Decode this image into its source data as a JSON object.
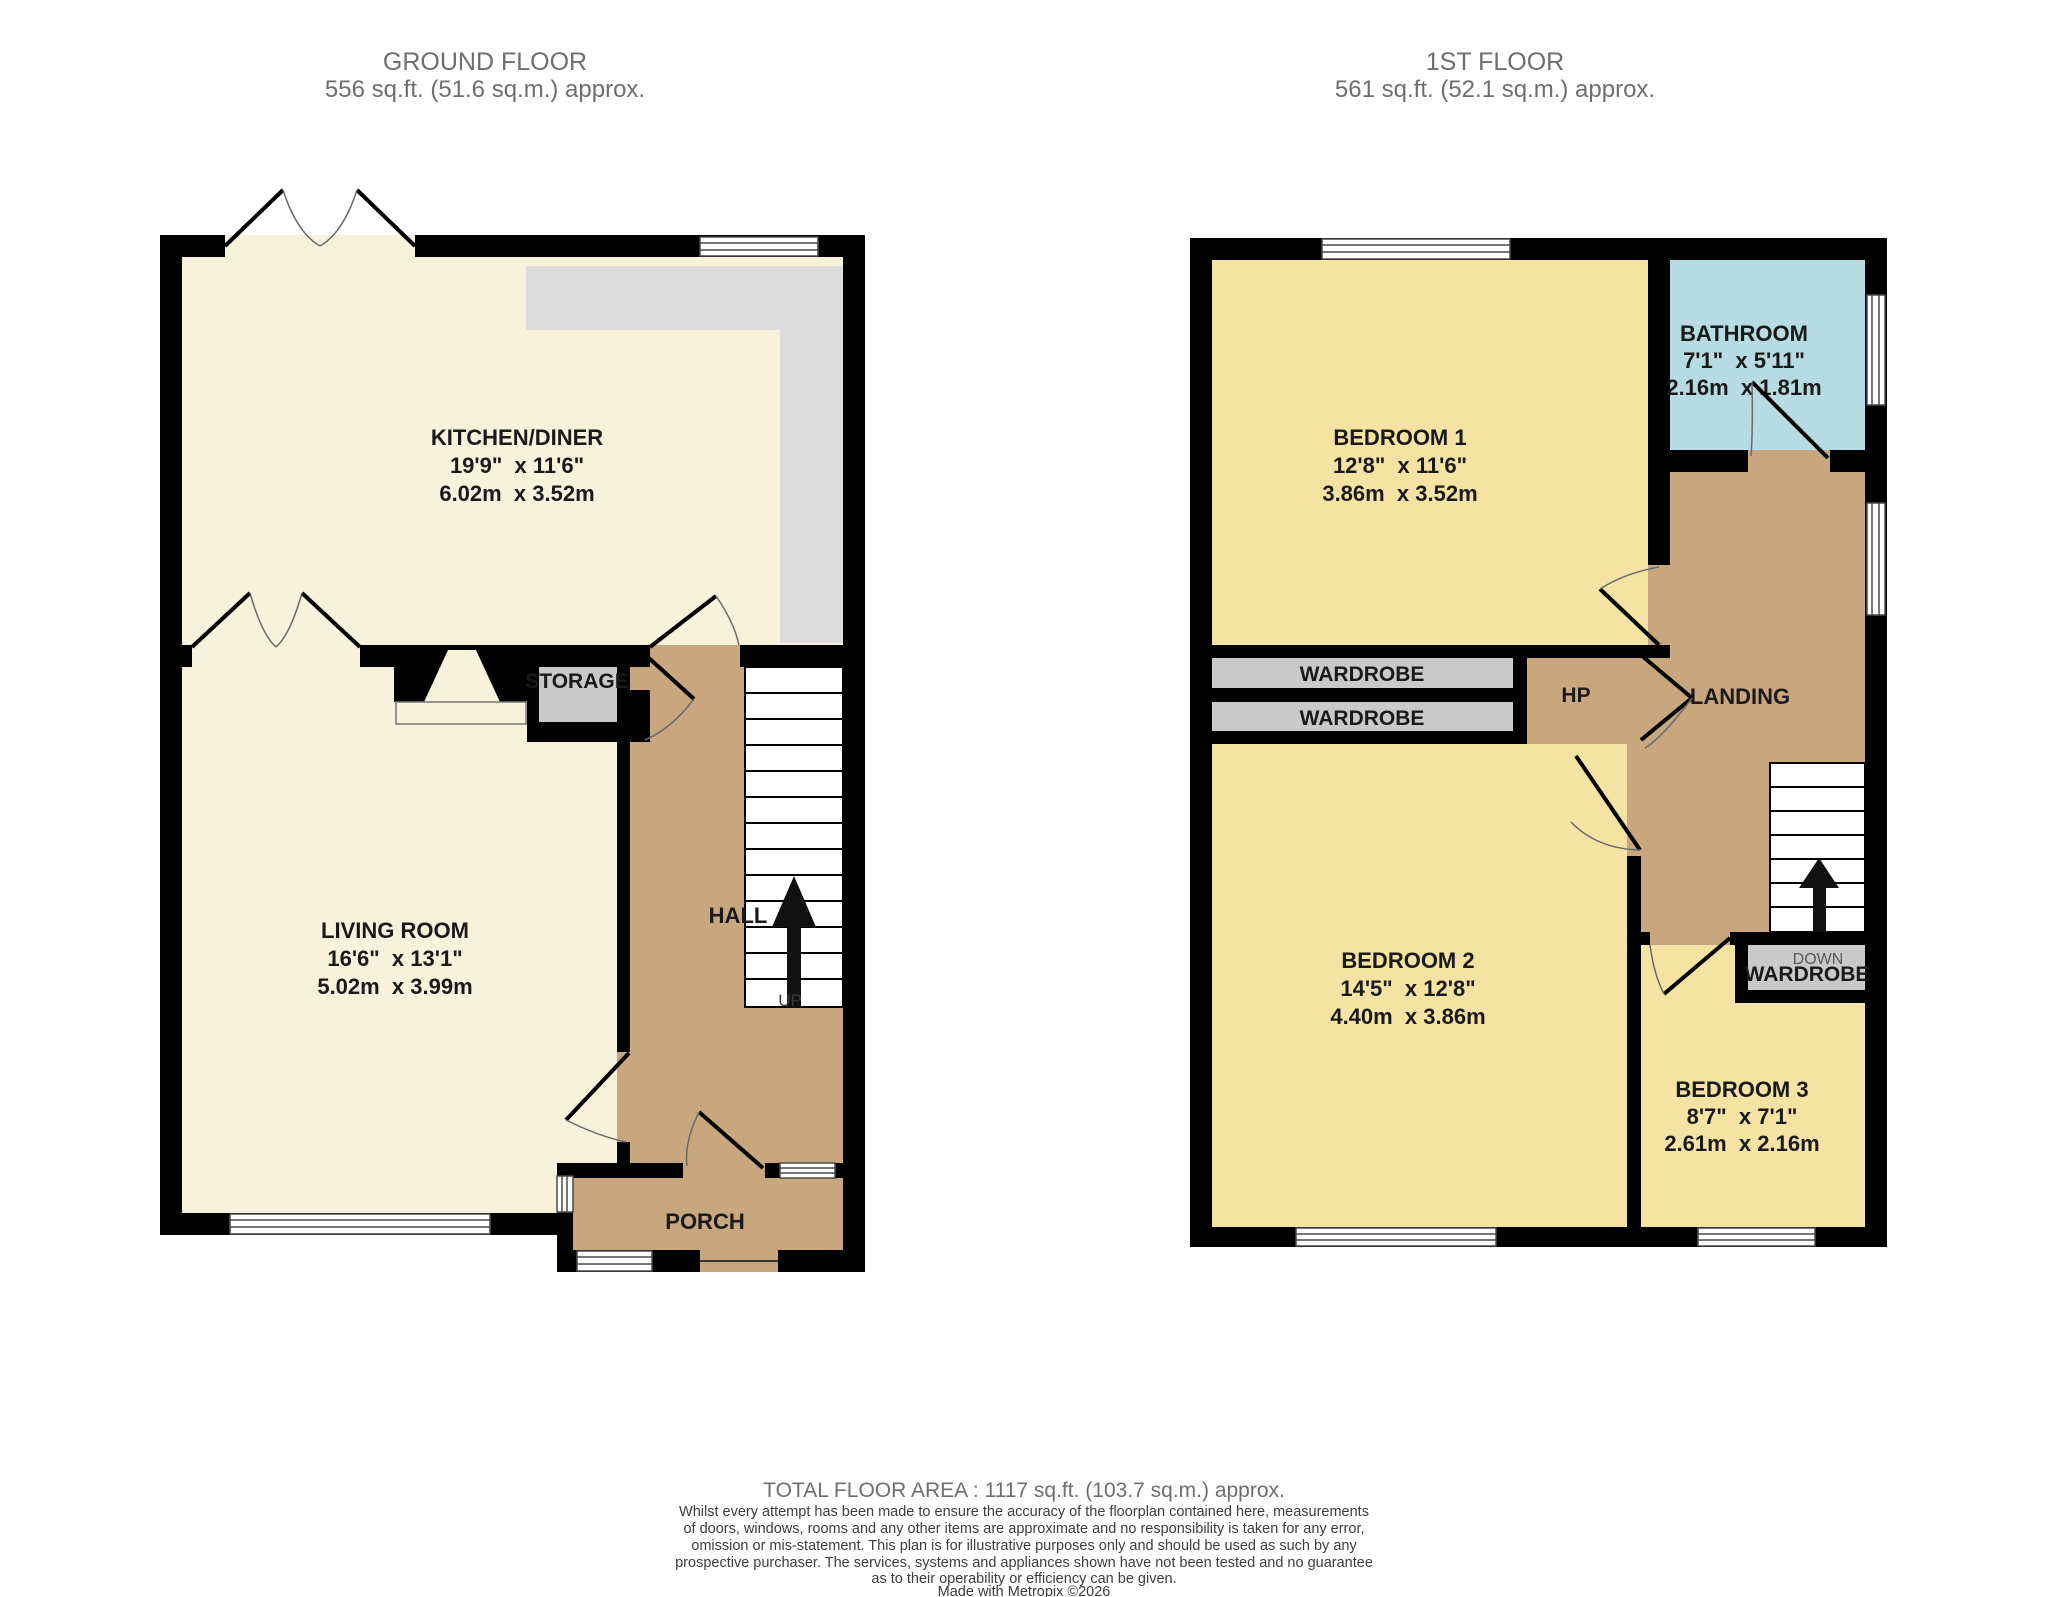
{
  "floors": {
    "ground": {
      "title": "GROUND FLOOR",
      "area": "556 sq.ft. (51.6 sq.m.) approx.",
      "rooms": {
        "kitchen": {
          "name": "KITCHEN/DINER",
          "imperial": "19'9\"  x 11'6\"",
          "metric": "6.02m  x 3.52m"
        },
        "living": {
          "name": "LIVING ROOM",
          "imperial": "16'6\"  x 13'1\"",
          "metric": "5.02m  x 3.99m"
        },
        "hall": {
          "name": "HALL"
        },
        "porch": {
          "name": "PORCH"
        },
        "storage": {
          "name": "STORAGE"
        }
      },
      "stairs_label": "UP"
    },
    "first": {
      "title": "1ST FLOOR",
      "area": "561 sq.ft. (52.1 sq.m.) approx.",
      "rooms": {
        "bedroom1": {
          "name": "BEDROOM 1",
          "imperial": "12'8\"  x 11'6\"",
          "metric": "3.86m  x 3.52m"
        },
        "bedroom2": {
          "name": "BEDROOM 2",
          "imperial": "14'5\"  x 12'8\"",
          "metric": "4.40m  x 3.86m"
        },
        "bedroom3": {
          "name": "BEDROOM 3",
          "imperial": "8'7\"  x 7'1\"",
          "metric": "2.61m  x 2.16m"
        },
        "bathroom": {
          "name": "BATHROOM",
          "imperial": "7'1\"  x 5'11\"",
          "metric": "2.16m  x 1.81m"
        },
        "landing": {
          "name": "LANDING"
        },
        "hp": {
          "name": "HP"
        },
        "wardrobe": "WARDROBE"
      },
      "stairs_label": "DOWN"
    }
  },
  "footer": {
    "total": "TOTAL FLOOR AREA : 1117 sq.ft. (103.7 sq.m.) approx.",
    "disclaimer_lines": [
      "Whilst every attempt has been made to ensure the accuracy of the floorplan contained here, measurements",
      "of doors, windows, rooms and any other items are approximate and no responsibility is taken for any error,",
      "omission or mis-statement. This plan is for illustrative purposes only and should be used as such by any",
      "prospective purchaser. The services, systems and appliances shown have not been tested and no guarantee",
      "as to their operability or efficiency can be given."
    ],
    "credit": "Made with Metropix ©2026"
  },
  "colors": {
    "room_cream": "#f7f2dc",
    "room_yellow": "#f5e3a4",
    "room_blue": "#b7dbe2",
    "hall_tan": "#c8a67e",
    "counter_gray": "#dcdcdc",
    "storage_gray": "#c9c9c9",
    "wall": "#000000",
    "title_gray": "#6e6e6e"
  }
}
